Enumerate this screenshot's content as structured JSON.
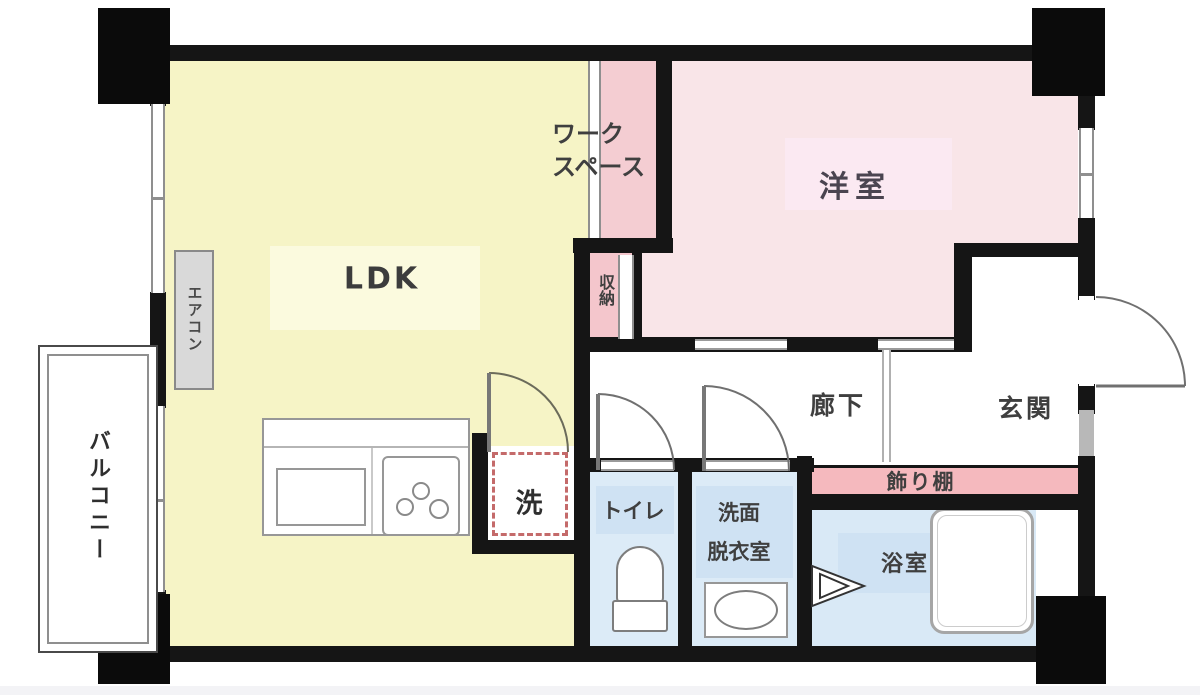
{
  "floorplan": {
    "type": "apartment-floor-plan",
    "rooms": {
      "ldk": "LDK",
      "workspace_line1": "ワーク",
      "workspace_line2": "スペース",
      "western_room": "洋室",
      "storage": "収納",
      "hallway": "廊下",
      "entrance": "玄関",
      "display_shelf": "飾り棚",
      "toilet": "トイレ",
      "washroom_line1": "洗面",
      "washroom_line2": "脱衣室",
      "bathroom": "浴室",
      "washer": "洗",
      "balcony": "バルコニー",
      "aircon": "エアコン"
    },
    "colors": {
      "ldk_floor": "#f6f4c6",
      "workspace_floor": "#f4cdd2",
      "western_room_floor": "#f9e5e8",
      "storage_floor": "#f4c6cc",
      "display_shelf": "#f5b9be",
      "toilet_washroom_floor": "#dcebf7",
      "bathroom_floor": "#d9e9f6",
      "wall": "#151515",
      "washer_dashed_border": "#c46a6a"
    }
  }
}
